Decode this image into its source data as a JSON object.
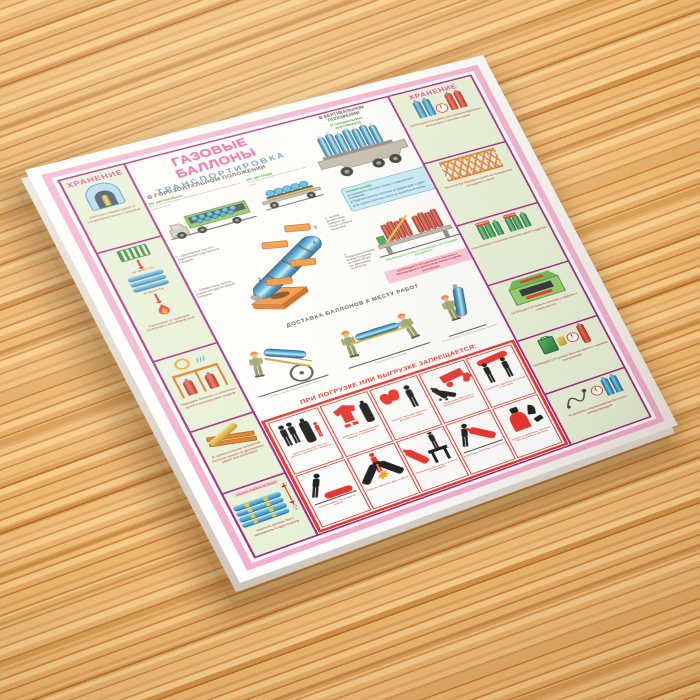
{
  "icons": {
    "warning_mark": "!"
  },
  "poster": {
    "title": "ГАЗОВЫЕ БАЛЛОНЫ",
    "subtitle": "ТРАНСПОРТИРОВКА",
    "accent_colors": {
      "frame_pink": "#f4afd0",
      "divider_magenta": "#a1247f",
      "cell_green": "#e7f2d8",
      "prohibit_red": "#e8312a",
      "title_pink": "#ee4fa0",
      "title_blue": "#4a86d8",
      "caption_green": "#2aa12e",
      "cylinder_blue": "#2c8ec4"
    },
    "storage_left": {
      "header": "ХРАНЕНИЕ",
      "cell1_caption": "Баллоны с газами хранят в специальных нишах с запорами",
      "cell2_label_top": "не менее 1 м",
      "cell2_label_bottom": "не менее 5 м",
      "cell2_caption": "Расстояние от приборов отопления и источников огня",
      "cell3_caption": "Защищать баллоны от солнечных лучей и атмосферных осадков",
      "cell4_caption": "В горизонтальном положении баллоны хранят на деревянных рамах или стеллажах",
      "cell5_label": "Высота штабеля не более",
      "cell5_height": "1,5 м",
      "cell5_caption": "Баллоны должны быть направлены в одну сторону"
    },
    "storage_right": {
      "header": "ХРАНЕНИЕ",
      "cell1_caption": "ЗАПРЕЩАЕТСЯ совместное хранение баллонов с кислородом и горючими газами",
      "cell2_caption": "Баллоны без башмаков хранят на огражденных площадках в клетях",
      "cell3_tag_full": "ПОЛНЫЕ",
      "cell3_tag_empty": "ПУСТЫЕ",
      "cell3_caption": "Наполненные и порожние баллоны хранят раздельно",
      "cell4_caption": "ЗАПРЕЩАЕТСЯ хранить баллоны в подвалах и низких местах",
      "cell5_caption": "ЗАПРЕЩАЕТСЯ хранить баллоны вместе с горючими материалами",
      "cell6_caption": "Не допускать соприкосновения баллонов с электропроводкой"
    },
    "horizontal": {
      "heading": "В ГОРИЗОНТАЛЬНОМ ПОЛОЖЕНИИ",
      "truck1_label": "На автомобиле",
      "truck1_caption": "Баллоны укладывают на деревянные подкладки вентилями в одну сторону",
      "truck2_label": "На автокаре",
      "truck2_caption": "Баллоны укладывают не более чем в три ряда"
    },
    "vertical": {
      "heading": "В ВЕРТИКАЛЬНОМ\nПОЛОЖЕНИИ",
      "sub_label": "В специальных\nконтейнерах",
      "note_title": "ПРИМЕЧАНИЕ:",
      "note_lines": [
        "Перевозить баллоны только с навернутыми колпаками",
        "Надежно крепить баллоны от ударов друг о друга",
        "Не грузить баллоны сверх установленной нормы"
      ],
      "container_caption": "Перевозка баллонов в контейнерах на площадке автомобиля",
      "warning_caption": "ЗАПРЕЩАЕТСЯ перевозить баллоны с кислородом и сжиженным газом в одном контейнере"
    },
    "diagram": {
      "items": [
        "1 - Деревянный брусок с вырезанными под баллоны гнездами",
        "2 - Обивка гнезд: войлок, резина или другой мягкий материал",
        "3 - Колпак должен быть навернут до отказа, штуцера заглушены",
        "4 - Предохранительные кольца толщиной не менее 25 мм (по два кольца на баллон)"
      ]
    },
    "delivery": {
      "heading": "ДОСТАВКА БАЛЛОНОВ К МЕСТУ РАБОТ",
      "caption1": "Перевозка на специальной тележке",
      "caption2": "Переноска на носилках",
      "caption3": "В отдельных случаях переноска на руках"
    },
    "prohibition": {
      "heading": "ПРИ ПОГРУЗКЕ ИЛИ ВЫГРУЗКЕ ЗАПРЕЩАЕТСЯ:",
      "cells": [
        {
          "caption": "работать малым числом рабочих (менее 2-х человек)"
        },
        {
          "caption": "работать в промасленной одежде и рукавицах"
        },
        {
          "caption": "грузить баллоны вместе с другими грузами"
        },
        {
          "caption": "сбрасывать баллоны с машины при разгрузке"
        },
        {
          "caption": "переносить баллоны на плечах и на спине"
        },
        {
          "caption": "перекатывать баллоны по земле"
        },
        {
          "caption": "ударять баллоны друг о друга"
        },
        {
          "caption": "сбрасывать баллоны с высоты и кантовать"
        },
        {
          "caption": "поднимать баллоны за вентиль"
        },
        {
          "caption": "грузить и выгружать баллоны без колпаков и заглушек"
        }
      ]
    }
  }
}
